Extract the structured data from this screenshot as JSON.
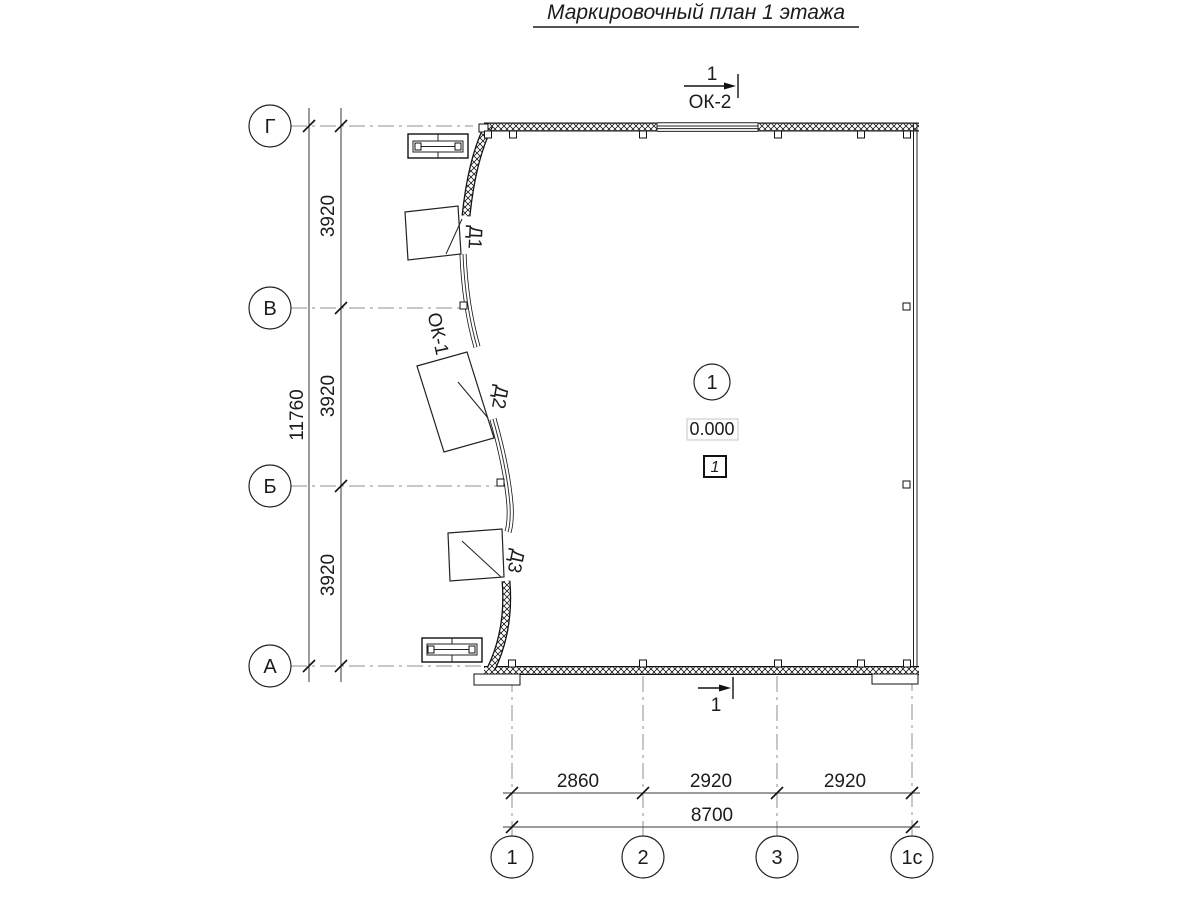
{
  "title": "Маркировочный план 1 этажа",
  "section_marks": {
    "top_number": "1",
    "top_window": "ОК-2",
    "bottom_number": "1"
  },
  "axes": {
    "left": [
      "Г",
      "В",
      "Б",
      "А"
    ],
    "bottom": [
      "1",
      "2",
      "3",
      "1с"
    ]
  },
  "dims": {
    "left_segments": [
      "3920",
      "3920",
      "3920"
    ],
    "left_total": "11760",
    "bottom_segments": [
      "2860",
      "2920",
      "2920"
    ],
    "bottom_total": "8700"
  },
  "labels": {
    "door1": "Д1",
    "door2": "Д2",
    "door3": "Д3",
    "window1": "ОК-1"
  },
  "room": {
    "number": "1",
    "elevation": "0.000",
    "floor_type": "1"
  }
}
